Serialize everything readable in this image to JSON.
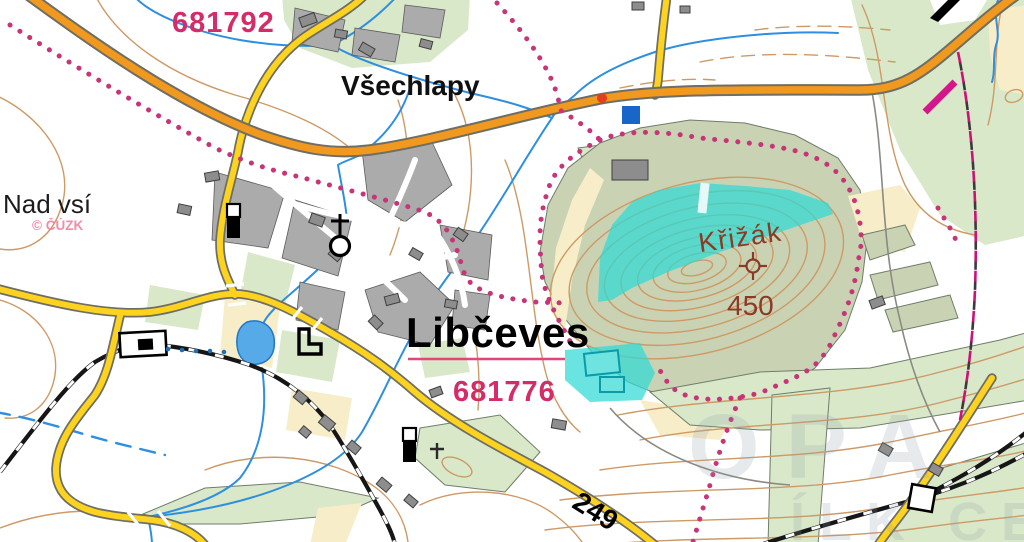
{
  "map": {
    "labels": {
      "parcel_top": "681792",
      "parcel_bottom": "681776",
      "village_small": "Všechlapy",
      "village_main": "Libčeves",
      "locality": "Nad vsí",
      "hill": "Křižák",
      "elevation": "450",
      "road_number": "249"
    },
    "attribution": "© ČÚZK",
    "watermark": {
      "line1": "OPA",
      "line2": "ÍLK CEL"
    },
    "symbols": {
      "church": "church-with-cross",
      "summit": "elevation-point",
      "station": "railway-station",
      "crossing": "railway-crossing",
      "cemetery_cross": "cemetery-cross"
    },
    "palette": {
      "contour": "#cd9a66",
      "field": "#f7eec9",
      "green-light": "#d9e8c9",
      "green-olive": "#c9d3b4",
      "cyan": "#2fd9d6",
      "water": "#2e8fe0",
      "pond": "#56aae8",
      "road-orange": "#f0991e",
      "road-yellow": "#fdd320",
      "casing": "#6e6e64",
      "rail": "#161616",
      "block-gray": "#ababab",
      "building": "#8d8d8d",
      "boundary-pink": "#c73579",
      "parcel-text": "#d42c68",
      "label-brown": "#8a3a26",
      "attribution": "#f27f9f",
      "magenta": "#cc1177"
    }
  }
}
